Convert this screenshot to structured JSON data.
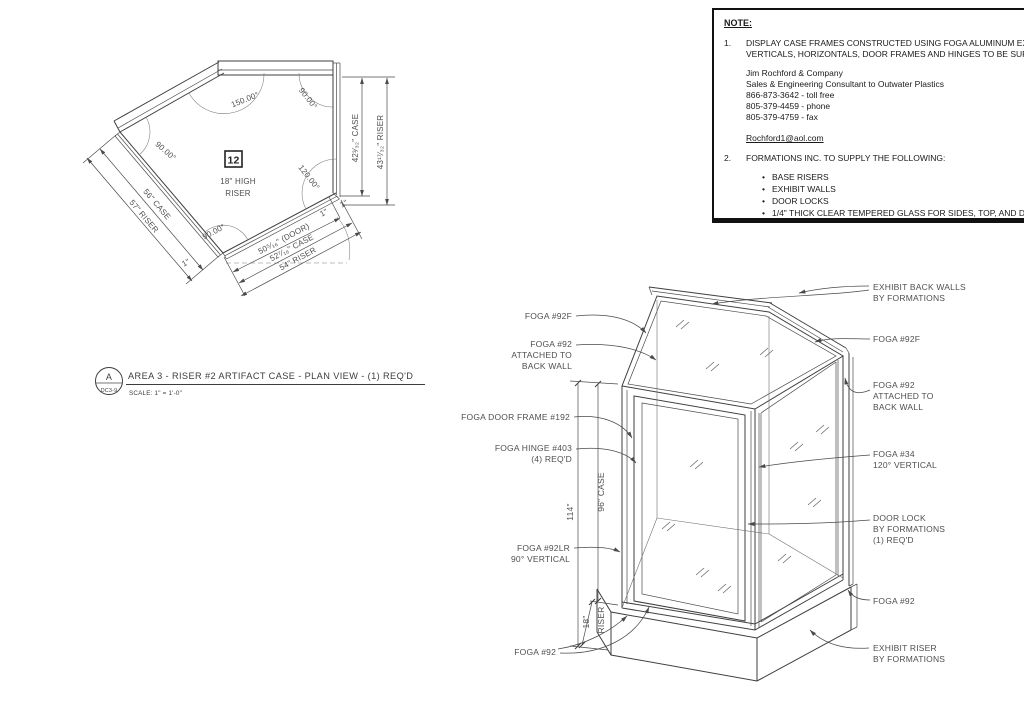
{
  "note_box": {
    "heading": "NOTE:",
    "items": [
      {
        "number": "1.",
        "lines": "DISPLAY CASE FRAMES CONSTRUCTED USING FOGA ALUMINUM EXTRUSIONS,\nVERTICALS, HORIZONTALS, DOOR FRAMES AND HINGES TO BE SUPPLIED BY:"
      },
      {
        "number": "2.",
        "lines": "FORMATIONS INC. TO SUPPLY THE FOLLOWING:"
      }
    ],
    "contact_lines": "Jim Rochford & Company\nSales & Engineering Consultant to Outwater Plastics\n866-873-3642 - toll free\n805-379-4459 - phone\n805-379-4759 - fax",
    "contact_email": "Rochford1@aol.com",
    "bullets": [
      "BASE RISERS",
      "EXHIBIT WALLS",
      "DOOR LOCKS",
      "1/4\" THICK CLEAR TEMPERED GLASS FOR SIDES, TOP, AND DOORS.\nALL GLASS PANELS TO HAVE FLAT POLISHED EDGES.",
      "POWDERCOAT ALL FRAMES/METAL: Cardinal E-141-BK19 Black Textured"
    ]
  },
  "plan_view": {
    "tag_number": "12",
    "tag_line1": "18\" HIGH",
    "tag_line2": "RISER",
    "angles": {
      "a150": "150.00°",
      "a90": "90.00°",
      "a120": "120.00°"
    },
    "dims": {
      "case_left": "56\" CASE",
      "riser_left": "57\" RISER",
      "case_right": "42³⁄₃₂\" CASE",
      "riser_right": "43¹⁷⁄₃₂\" RISER",
      "door": "50⁵⁄₁₆\" (DOOR)",
      "case_bottom": "52⁷⁄₁₆\" CASE",
      "riser_bottom": "54\" RISER",
      "one_inch": "1\""
    },
    "title": {
      "detail_letter": "A",
      "detail_sheet": "DC3-9",
      "text": "AREA 3 - RISER #2 ARTIFACT CASE - PLAN VIEW - (1) REQ'D",
      "scale": "SCALE: 1\" = 1'-0\""
    }
  },
  "iso_view": {
    "labels_left": [
      [
        "FOGA #92F"
      ],
      [
        "FOGA #92",
        "ATTACHED TO",
        "BACK WALL"
      ],
      [
        "FOGA DOOR FRAME #192"
      ],
      [
        "FOGA HINGE #403",
        "(4) REQ'D"
      ],
      [
        "FOGA #92LR",
        "90° VERTICAL"
      ],
      [
        "FOGA #92"
      ]
    ],
    "labels_right": [
      [
        "EXHIBIT BACK WALLS",
        "BY FORMATIONS"
      ],
      [
        "FOGA #92F"
      ],
      [
        "FOGA #92",
        "ATTACHED TO",
        "BACK WALL"
      ],
      [
        "FOGA #34",
        "120° VERTICAL"
      ],
      [
        "DOOR LOCK",
        "BY FORMATIONS",
        "(1) REQ'D"
      ],
      [
        "FOGA #92"
      ],
      [
        "EXHIBIT RISER",
        "BY FORMATIONS"
      ]
    ],
    "dims": {
      "total": "114\"",
      "case": "96\" CASE",
      "riser": "18\"",
      "riser_word": "RISER"
    }
  }
}
